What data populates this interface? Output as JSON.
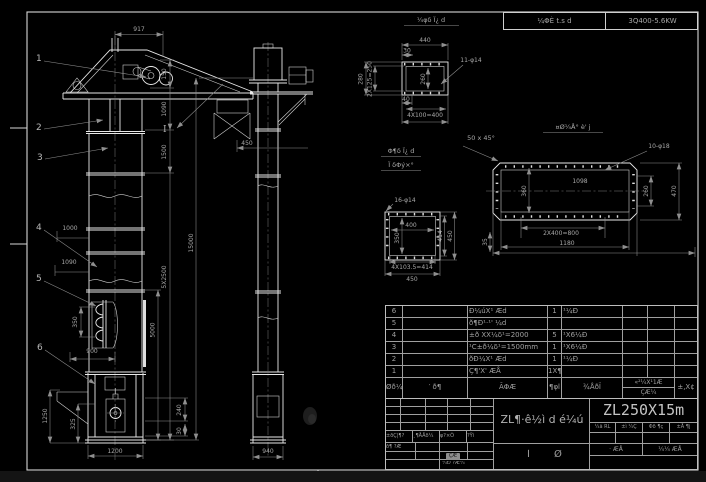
{
  "colors": {
    "background": "#000000",
    "main_line": "#e9e9e9",
    "dimension": "#8f8f8f",
    "dim_text": "#a8a8a8",
    "frame": "#d6d6d6",
    "model_text": "#c4c4c4",
    "stamp_fill": "#8d8d8d"
  },
  "header": {
    "process_cell": "¼ΦÈ t.s d",
    "motor_cell": "3Q400-5.6KW"
  },
  "front_view": {
    "balloons": [
      "1",
      "2",
      "3",
      "4",
      "5",
      "6"
    ],
    "section_label": "I",
    "dims": {
      "width_top": "917",
      "h_150": "150",
      "h_1090": "1090",
      "h_1500": "1500",
      "h_sections": "5X2500",
      "h_total": "15000",
      "w_1000": "1000",
      "w_1090": "1090",
      "bucket_pitch": "350",
      "w_900": "900",
      "h_5000": "5000",
      "h_240": "240",
      "h_30": "30",
      "h_1250": "1250",
      "h_325": "325",
      "w_base": "1200"
    }
  },
  "side_view": {
    "dims": {
      "w_450": "450",
      "w_base": "940"
    }
  },
  "detail_top_flange": {
    "title": "¼φδ Ï¿ d",
    "dims": {
      "w_440": "440",
      "w_30": "30",
      "holes": "11-φ14",
      "left_280": "280",
      "left_pitch": "2X125=250",
      "inner_260": "260",
      "b_40": "40",
      "b_pitch": "4X100=400"
    }
  },
  "chamfer_note": "50 x 45°",
  "detail_side_flange": {
    "title": "¤Ø¼Å° è' j",
    "dims": {
      "holes": "10-φ18",
      "label_1098": "1098",
      "inner_360": "360",
      "r_260": "260",
      "r_470": "470",
      "b_pitch": "2X400=800",
      "b_1180": "1180",
      "l_35": "35"
    }
  },
  "detail_square_flange": {
    "title_line1": "Φ¶δ Ï¿ d",
    "title_line2": "Ï δΦý×°",
    "dims": {
      "holes": "16-φ14",
      "inner_w": "400",
      "inner_h": "350",
      "r_414": "414",
      "r_450": "450",
      "b_pitch": "4X103.5=414",
      "b_450": "450"
    }
  },
  "parts_table": {
    "header": {
      "no": "Øð¼",
      "code": "′ ð¶",
      "name": "ÃΦÆ",
      "qty": "¶φl",
      "material": "¾ÅðÏ",
      "weight_top": "«²¼X¹1Æ",
      "weight_bottom": "ÇÆ¼",
      "remark": "±,X¢"
    },
    "rows": [
      {
        "no": "6",
        "code": "",
        "name": "Ð¼úX¹ Æd",
        "qty": "1",
        "material": "¹¼Ð"
      },
      {
        "no": "5",
        "code": "",
        "name": "ð¶Ð¹·¹' ¼d",
        "qty": "",
        "material": ""
      },
      {
        "no": "4",
        "code": "",
        "name": "±ð XΧ¼δ¹=2000",
        "qty": "5",
        "material": "¹Χ6¼Ð"
      },
      {
        "no": "3",
        "code": "",
        "name": "¹C±ð¼δ¹=1500mm",
        "qty": "1",
        "material": "¹Χ6¼Ð"
      },
      {
        "no": "2",
        "code": "",
        "name": "ðÐ¼X¹ Æd",
        "qty": "1",
        "material": "¹¼Ð"
      },
      {
        "no": "1",
        "code": "",
        "name": "Ç¶'X' ÆÅ",
        "qty": "1X¶δÆ·",
        "material": ""
      }
    ]
  },
  "title_block": {
    "drawing_name": "ZL¶·ê½ì d é¼ú",
    "model": "ZL250X15m",
    "sig_cells": [
      "±ðÇ|¶?",
      "¸¶ÅÅð¼",
      "φ?×Ò",
      "?Ŷì"
    ],
    "sig_label": "ð¶ ?Æ",
    "stamp": "ÇÆ",
    "bottom_label": "¼Ð ?Æ¼",
    "right_cells": [
      "¼ã RL",
      "±ì ¼Ç",
      "Φð ¶ç",
      "±Å ¶j"
    ],
    "scale_left": "· ÆÅ",
    "scale_right": "¼¼ ÆÅ",
    "sheet_mark_1": "Ì",
    "sheet_mark_2": "Ø"
  }
}
